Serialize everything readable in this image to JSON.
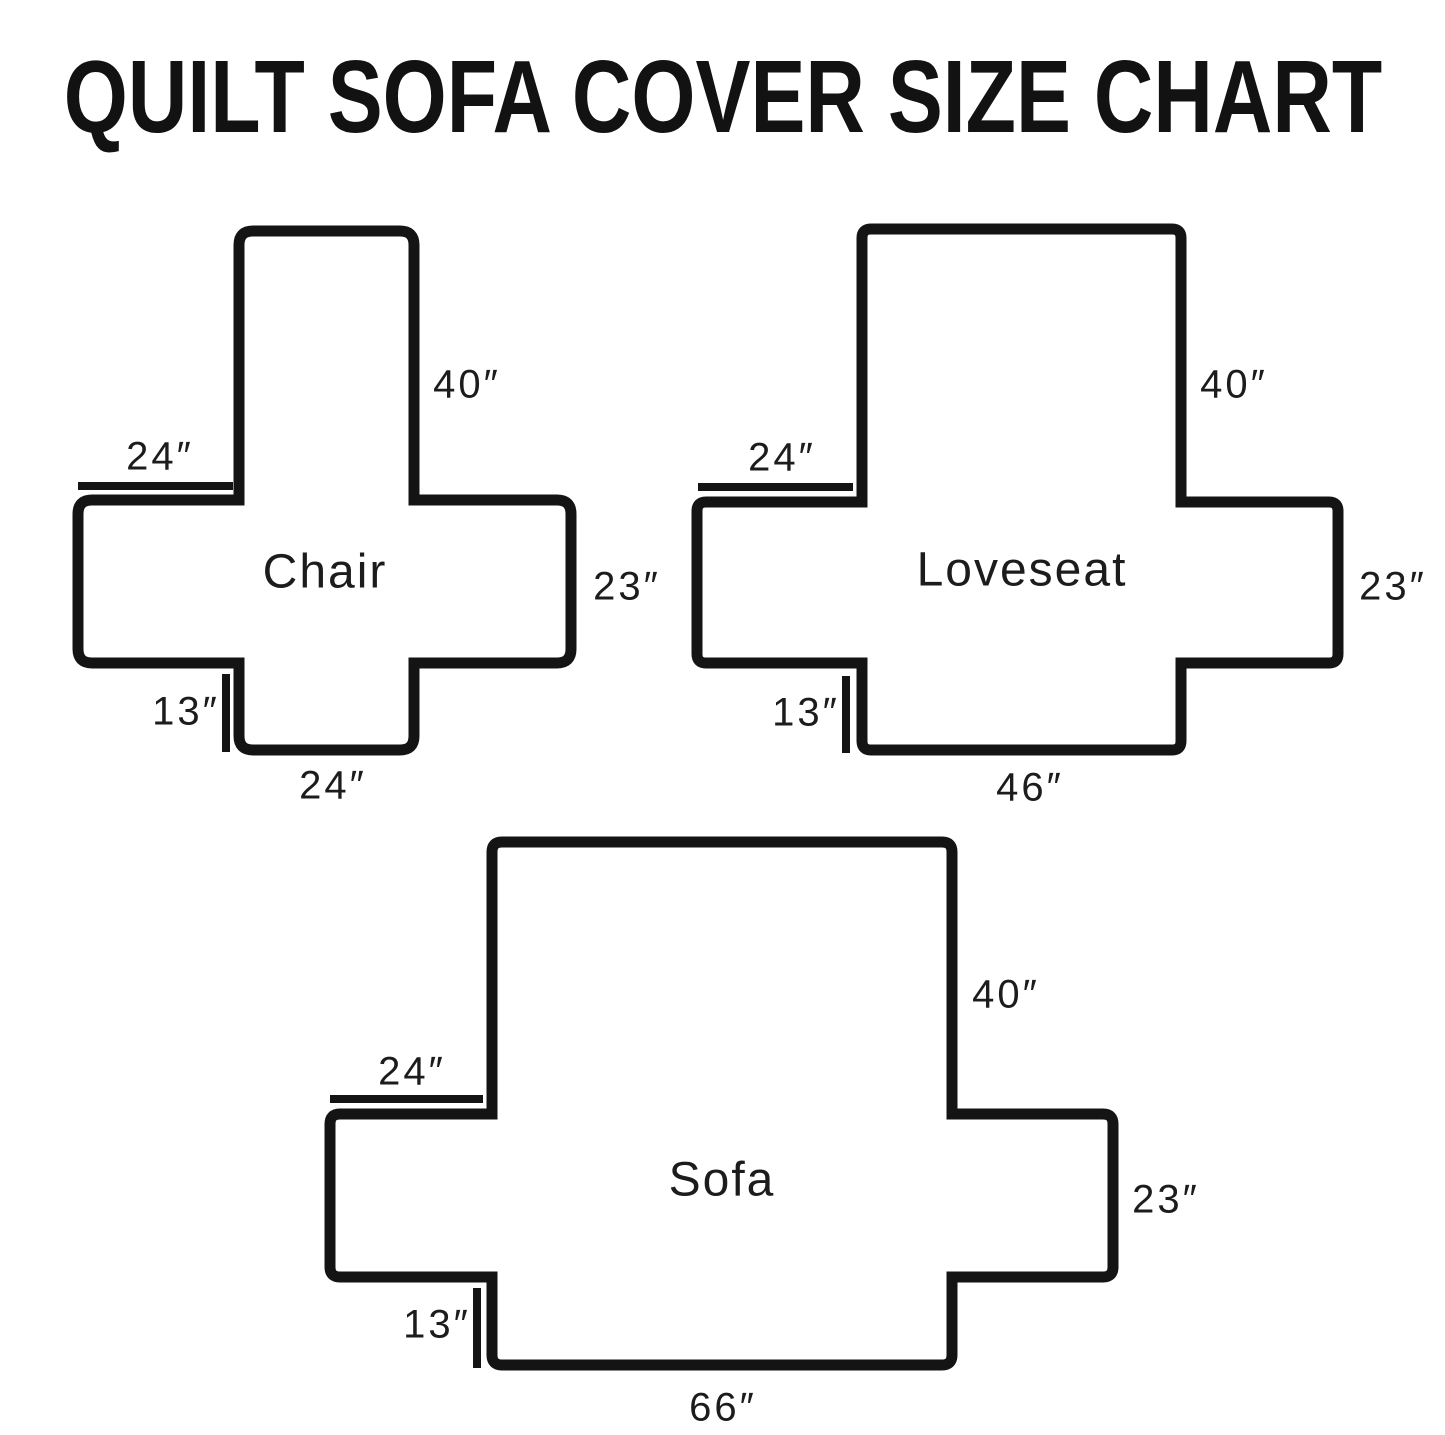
{
  "title": "QUILT SOFA COVER SIZE CHART",
  "figures": {
    "chair": {
      "name": "Chair",
      "back_height": "40″",
      "arm_top_width": "24″",
      "arm_side_depth": "23″",
      "front_flap_height": "13″",
      "seat_width": "24″"
    },
    "loveseat": {
      "name": "Loveseat",
      "back_height": "40″",
      "arm_top_width": "24″",
      "arm_side_depth": "23″",
      "front_flap_height": "13″",
      "seat_width": "46″"
    },
    "sofa": {
      "name": "Sofa",
      "back_height": "40″",
      "arm_top_width": "24″",
      "arm_side_depth": "23″",
      "front_flap_height": "13″",
      "seat_width": "66″"
    }
  },
  "colors": {
    "outline": "#141414",
    "text": "#1c1c1c"
  }
}
